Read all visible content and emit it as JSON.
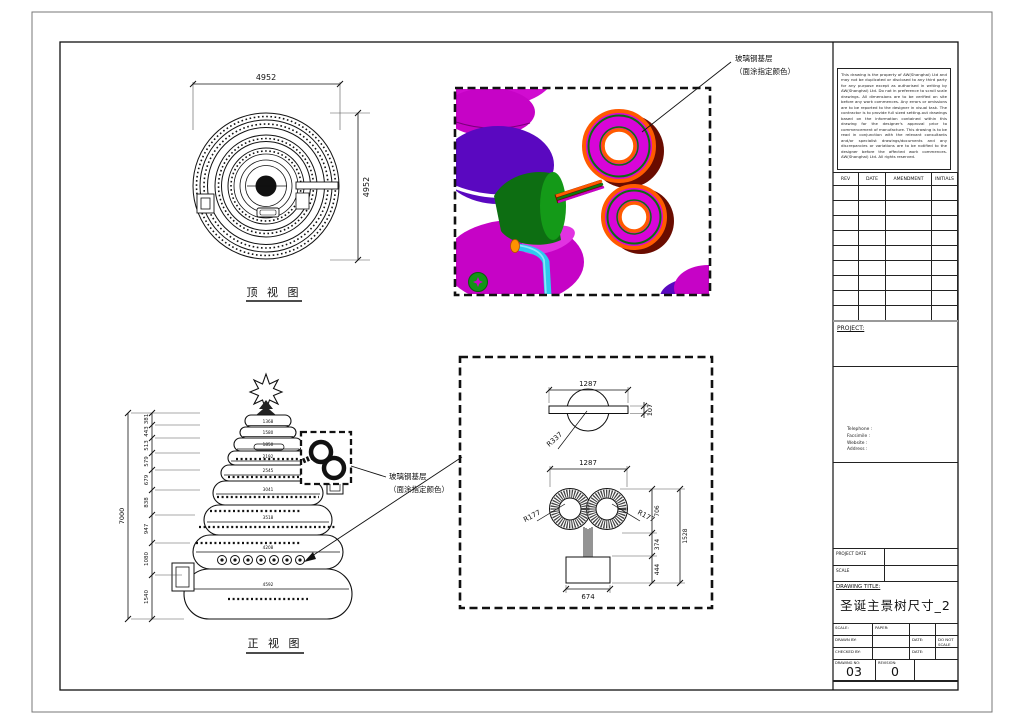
{
  "callouts": {
    "frp_line1": "玻璃钢基层",
    "frp_line2": "（面涂指定颜色）"
  },
  "top_view": {
    "label": "顶 视 图",
    "dim_width": "4952",
    "dim_height": "4952"
  },
  "front_view": {
    "label": "正 视 图",
    "overall_height": "7000",
    "segment_dims": [
      "381",
      "443",
      "513",
      "579",
      "679",
      "838",
      "947",
      "1080",
      "1540"
    ],
    "tier_widths": [
      "1368",
      "1580",
      "1850",
      "2192",
      "2545",
      "3041",
      "3518",
      "4208",
      "4592"
    ]
  },
  "detail_view": {
    "top": {
      "width": "1287",
      "thickness": "107",
      "radius": "R337"
    },
    "bottom": {
      "width": "1287",
      "radius_left": "R177",
      "radius_right": "R177",
      "dim_upper": "706",
      "dim_mid": "374",
      "dim_lower": "444",
      "dim_total": "1528",
      "base_width": "674"
    }
  },
  "title_block": {
    "disclaimer": "This drawing is the property of AW(Shanghai) Ltd and may not be duplicated or disclosed to any third party for any purpose except as authorised in writing by AW(Shanghai) Ltd. Do not in preference to scroll scale drawings. All dimensions are to be verified on site before any work commences. Any errors or omissions are to be reported to the designer in visual task. The contractor is to provide full sized setting-out drawings based on the information contained within this drawing for the designer's approval prior to commencement of manufacture. This drawing is to be read in conjunction with the relevant consultants and/or specialist drawings/documents and any discrepancies or variations are to be notified to the designer before the affected work commences. AW(Shanghai) Ltd. All rights reserved.",
    "revision_table": {
      "headers": [
        "REV",
        "DATE",
        "AMENDMENT",
        "INITIALS"
      ]
    },
    "project_label": "PROJECT:",
    "contact": {
      "telephone": "Telephone :",
      "facsimile": "Facsimile :",
      "website": "Website :",
      "address": "Address :"
    },
    "project_date_label": "PROJECT DATE",
    "scale_row_label": "SCALE",
    "drawing_title_label": "DRAWING TITLE:",
    "drawing_title": "圣诞主景树尺寸_2",
    "fields": {
      "scale_label": "SCALE:",
      "paper_label": "PAPER:",
      "drawn_by_label": "DRAWN BY:",
      "date_label": "DATE:",
      "do_not_scale": "DO NOT SCALE",
      "checked_by_label": "CHECKED BY:",
      "drawing_no_label": "DRAWING NO:",
      "drawing_no": "03",
      "revision_label": "REVISION:",
      "revision": "0"
    }
  },
  "colors": {
    "magenta": "#c603c6",
    "purple": "#5a08c0",
    "green": "#0d6e12",
    "cyan": "#2ec9ee",
    "orange": "#ff5a00",
    "dark_red": "#6a0c00",
    "line": "#111111"
  }
}
